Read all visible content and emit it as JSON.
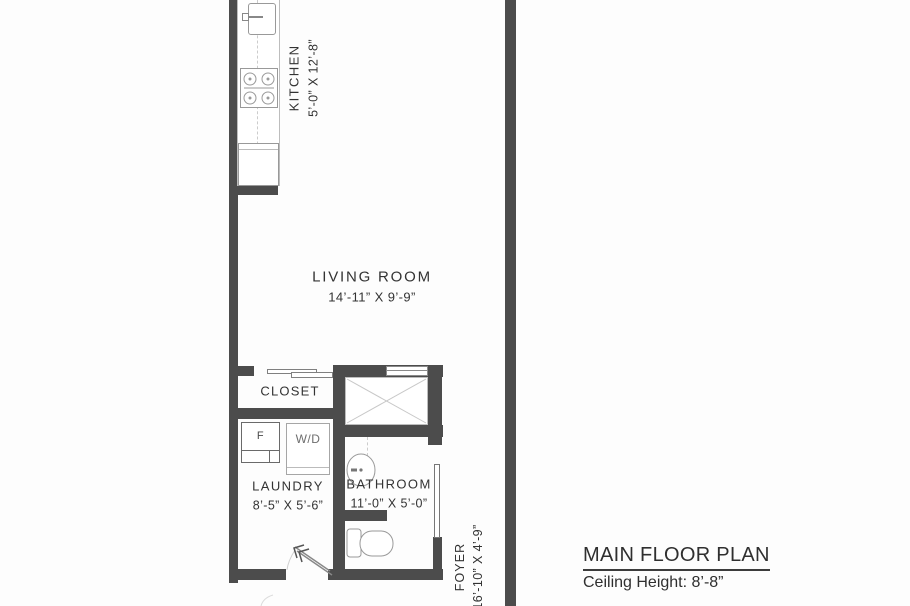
{
  "plan": {
    "title": "MAIN FLOOR PLAN",
    "ceiling_note": "Ceiling Height: 8’-8”"
  },
  "rooms": {
    "kitchen": {
      "name": "KITCHEN",
      "dims": "5’-0” X 12’-8”"
    },
    "living_room": {
      "name": "LIVING ROOM",
      "dims": "14’-11” X 9’-9”"
    },
    "closet": {
      "name": "CLOSET"
    },
    "laundry": {
      "name": "LAUNDRY",
      "dims": "8’-5” X 5’-6”"
    },
    "bathroom": {
      "name": "BATHROOM",
      "dims": "11’-0” X 5’-0”"
    },
    "foyer": {
      "name": "FOYER",
      "dims": "16’-10” X 4’-9”"
    }
  },
  "appliances": {
    "furnace": "F",
    "washer_dryer": "W/D"
  },
  "colors": {
    "wall": "#4c4c4c",
    "text": "#333333",
    "bg": "#fdfdfd",
    "fix": "#a6a6a6"
  }
}
